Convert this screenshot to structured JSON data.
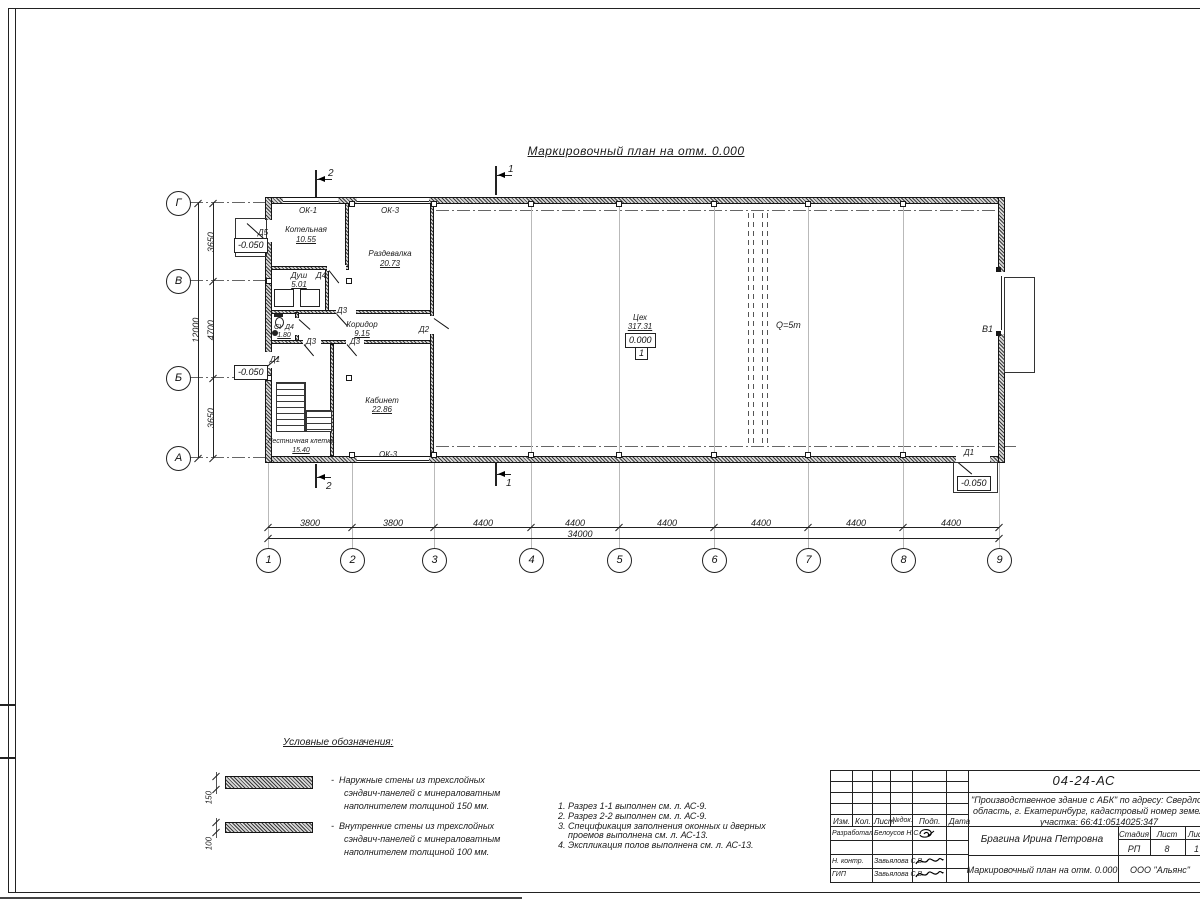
{
  "sheet": {
    "main_title": "Маркировочный план на отм. 0.000",
    "legend_title": "Условные обозначения:",
    "legend": [
      {
        "thickness": "150",
        "lines": [
          "-  Наружные стены из трехслойных",
          "сэндвич-панелей с минераловатным",
          "наполнителем толщиной 150 мм."
        ]
      },
      {
        "thickness": "100",
        "lines": [
          "-  Внутренние стены из трехслойных",
          "сэндвич-панелей с минераловатным",
          "наполнителем толщиной 100 мм."
        ]
      }
    ],
    "notes": [
      "1. Разрез 1-1 выполнен см. л. АС-9.",
      "2. Разрез 2-2 выполнен см. л. АС-9.",
      "3. Спецификация заполнения оконных и дверных",
      "    проемов выполнена см. л. АС-13.",
      "4. Экспликация полов выполнена см. л. АС-13."
    ]
  },
  "plan": {
    "axes_cols": [
      "1",
      "2",
      "3",
      "4",
      "5",
      "6",
      "7",
      "8",
      "9"
    ],
    "axes_rows": [
      "Г",
      "В",
      "Б",
      "А"
    ],
    "dims_bottom": [
      "3800",
      "3800",
      "4400",
      "4400",
      "4400",
      "4400",
      "4400",
      "4400"
    ],
    "dim_bottom_total": "34000",
    "dims_left": [
      "3650",
      "4700",
      "3650"
    ],
    "dim_left_total": "12000",
    "rooms": {
      "kotelnaya": {
        "name": "Котельная",
        "area": "10.55"
      },
      "razdevalka": {
        "name": "Раздевалка",
        "area": "20.73"
      },
      "dush": {
        "name": "Душ",
        "area": "5.01"
      },
      "su": {
        "name": "СУ Д4",
        "area": "1.80"
      },
      "koridor": {
        "name": "Коридор",
        "area": "9.15"
      },
      "kabinet": {
        "name": "Кабинет",
        "area": "22.86"
      },
      "lestnichnaya": {
        "name": "Лестничная клетка",
        "area": "15.40"
      },
      "tseh": {
        "name": "Цех",
        "area": "317.31"
      }
    },
    "marks": {
      "level_zero": "0.000",
      "level_minus": "-0.050",
      "floor_type": "1",
      "crane": "Q=5т",
      "gate": "В1",
      "door1": "Д1",
      "door2": "Д2",
      "door3": "Д3",
      "door4": "Д4",
      "door5": "Д5",
      "window1": "ОК-1",
      "window3": "ОК-3",
      "section1": "1",
      "section2": "2"
    }
  },
  "titleblock": {
    "doc_number": "04-24-АС",
    "project_lines": [
      "\"Производственное здание с АБК\" по адресу: Свердлов",
      "область, г. Екатеринбург, кадастровый номер земель",
      "участка: 66:41:0514025:347"
    ],
    "columns": {
      "izm": "Изм.",
      "kol": "Кол.",
      "list": "Лист",
      "ndok": "№док.",
      "podp": "Подп.",
      "data": "Дата"
    },
    "row_razrabotal": {
      "role": "Разработал",
      "name": "Белоусов Н.С."
    },
    "row_nkontr": {
      "role": "Н. контр.",
      "name": "Завьялова С.В."
    },
    "row_gip": {
      "role": "ГИП",
      "name": "Завьялова С.В."
    },
    "author": "Брагина Ирина Петровна",
    "sheet_name": "Маркировочный план на отм. 0.000",
    "stage_cols": {
      "stadia": "Стадия",
      "list": "Лист",
      "listov": "Лис"
    },
    "stage_vals": {
      "stadia": "РП",
      "list": "8",
      "listov": "1"
    },
    "company": "ООО \"Альянс\""
  }
}
